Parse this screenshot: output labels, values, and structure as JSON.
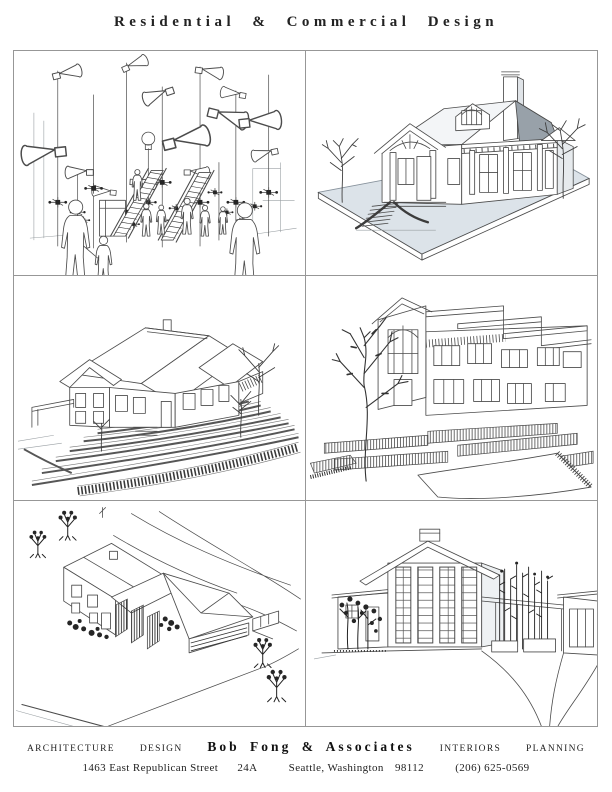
{
  "page": {
    "title": "Residential & Commercial Design"
  },
  "panels": [
    {
      "name": "kinetic-sculpture-plaza-drawing"
    },
    {
      "name": "craftsman-house-rendering"
    },
    {
      "name": "terraced-residence-isometric-drawing"
    },
    {
      "name": "hillside-house-perspective-drawing"
    },
    {
      "name": "aerial-site-axonometric-drawing"
    },
    {
      "name": "modern-house-entry-perspective-drawing"
    }
  ],
  "footer": {
    "services": [
      "ARCHITECTURE",
      "DESIGN",
      "INTERIORS",
      "PLANNING"
    ],
    "firm": "Bob Fong & Associates",
    "address": {
      "street": "1463 East Republican Street",
      "unit": "24A",
      "city": "Seattle, Washington",
      "zip": "98112",
      "phone": "(206) 625-0569"
    }
  },
  "colors": {
    "panel_border": "#979797",
    "ink": "#4c4c4c",
    "ground_plane": "#dce3e9",
    "roof_shade": "#98a1a9"
  }
}
